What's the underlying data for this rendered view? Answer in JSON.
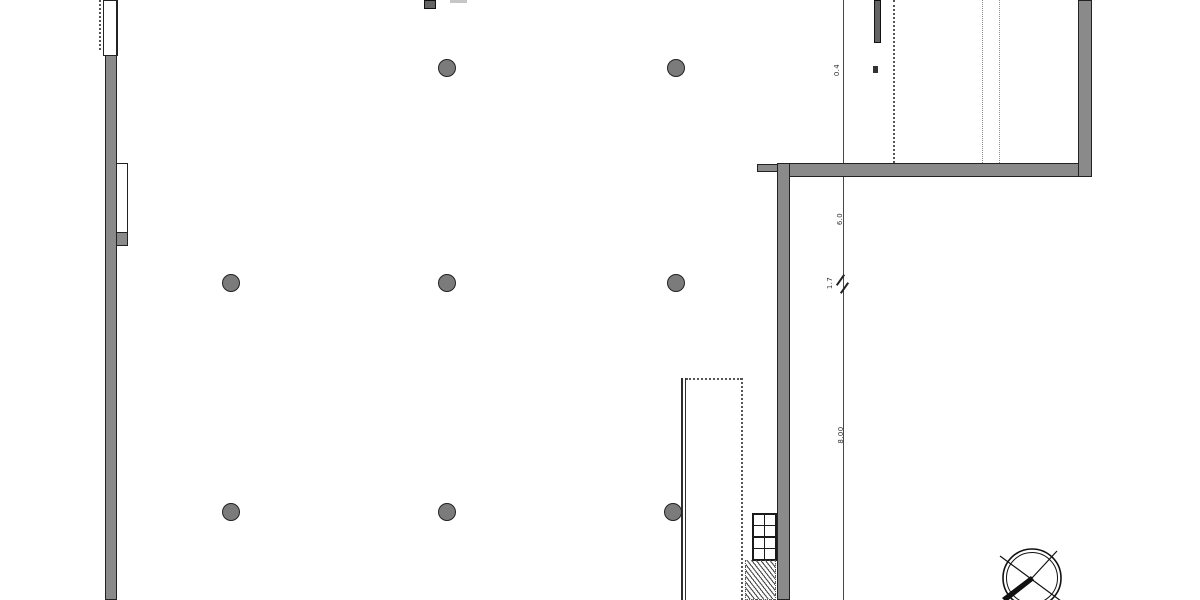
{
  "canvas": {
    "width": 1200,
    "height": 600,
    "background": "#ffffff"
  },
  "palette": {
    "wall_fill": "#8a8a8a",
    "edge": "#222222",
    "line": "#474747",
    "dotted": "#555555",
    "light": "#c6c6c6",
    "pier_fill": "#636363",
    "column_fill": "#7b7b7b",
    "text": "#333333"
  },
  "labels": [
    {
      "name": "dim-label-top",
      "text": "0.4",
      "x": 837,
      "y": 70
    },
    {
      "name": "dim-label-mid",
      "text": "6.0",
      "x": 840,
      "y": 219
    },
    {
      "name": "dim-label-tick",
      "text": "1.7",
      "x": 830,
      "y": 283
    },
    {
      "name": "dim-label-low",
      "text": "8.00",
      "x": 841,
      "y": 435
    }
  ],
  "shapes": [
    {
      "name": "left-wall",
      "cls": "wall",
      "x": 105,
      "y": 52,
      "w": 12,
      "h": 548
    },
    {
      "name": "left-wall-top-opening",
      "cls": "white-box thick-right",
      "x": 103,
      "y": 0,
      "w": 15,
      "h": 56
    },
    {
      "name": "left-guide-dashed-line",
      "cls": "dot-vline",
      "x": 99,
      "y": 0,
      "w": 0,
      "h": 50
    },
    {
      "name": "left-wall-niche",
      "cls": "white-box",
      "x": 116,
      "y": 163,
      "w": 12,
      "h": 70
    },
    {
      "name": "left-wall-niche-sill",
      "cls": "gray-box",
      "x": 116,
      "y": 232,
      "w": 12,
      "h": 14
    },
    {
      "name": "top-wall-pier",
      "cls": "dark-box",
      "x": 424,
      "y": 0,
      "w": 12,
      "h": 9
    },
    {
      "name": "top-light-segment",
      "cls": "light-seg",
      "x": 450,
      "y": 0,
      "w": 17,
      "h": 3
    },
    {
      "name": "structural-grid-line",
      "cls": "thin-vline",
      "x": 843,
      "y": 0,
      "w": 1,
      "h": 600
    },
    {
      "name": "guide-dotted-line-1",
      "cls": "dot-vline",
      "x": 893,
      "y": 0,
      "w": 0,
      "h": 163
    },
    {
      "name": "guide-dotted-line-2",
      "cls": "dot-vline-light",
      "x": 982,
      "y": 0,
      "w": 0,
      "h": 163
    },
    {
      "name": "guide-dotted-line-3",
      "cls": "dot-vline-light",
      "x": 999,
      "y": 0,
      "w": 0,
      "h": 163
    },
    {
      "name": "upper-wall-pier",
      "cls": "dark-box",
      "x": 874,
      "y": 0,
      "w": 7,
      "h": 43
    },
    {
      "name": "small-marker",
      "cls": "solid-fill",
      "x": 873,
      "y": 66,
      "w": 5,
      "h": 7
    },
    {
      "name": "upper-right-wall-horizontal",
      "cls": "wall",
      "x": 777,
      "y": 163,
      "w": 315,
      "h": 14
    },
    {
      "name": "upper-right-wall-stub",
      "cls": "wall",
      "x": 757,
      "y": 164,
      "w": 21,
      "h": 8
    },
    {
      "name": "mid-right-wall-vertical",
      "cls": "wall",
      "x": 777,
      "y": 163,
      "w": 13,
      "h": 437
    },
    {
      "name": "far-right-wall-vertical",
      "cls": "wall",
      "x": 1078,
      "y": 0,
      "w": 14,
      "h": 177
    },
    {
      "name": "shaft-left-double-line",
      "cls": "dbl-vline",
      "x": 681,
      "y": 378,
      "w": 5,
      "h": 222
    },
    {
      "name": "shaft-top-dotted-line",
      "cls": "dot-hline",
      "x": 686,
      "y": 378,
      "w": 56,
      "h": 0
    },
    {
      "name": "shaft-right-dotted-line",
      "cls": "dot-vline",
      "x": 741,
      "y": 378,
      "w": 0,
      "h": 222
    },
    {
      "name": "stair-break-hatch",
      "cls": "hatch",
      "x": 745,
      "y": 560,
      "w": 31,
      "h": 40
    },
    {
      "name": "dimension-tick-1",
      "cls": "tick",
      "x": 834,
      "y": 279,
      "w": 13,
      "h": 2
    },
    {
      "name": "dimension-tick-2",
      "cls": "tick",
      "x": 838,
      "y": 287,
      "w": 13,
      "h": 2
    }
  ],
  "columns": {
    "radius": 9,
    "points": [
      [
        447,
        68
      ],
      [
        676,
        68
      ],
      [
        231,
        283
      ],
      [
        447,
        283
      ],
      [
        676,
        283
      ],
      [
        231,
        512
      ],
      [
        447,
        512
      ],
      [
        673,
        512
      ]
    ]
  },
  "stairs": {
    "x": 752,
    "y": 513,
    "w": 25,
    "h": 48,
    "rows": 4,
    "cols": 2
  },
  "compass": {
    "icon": "north-arrow-icon",
    "cx": 1032,
    "cy": 578,
    "r_outer": 29,
    "r_inner": 25.5
  }
}
